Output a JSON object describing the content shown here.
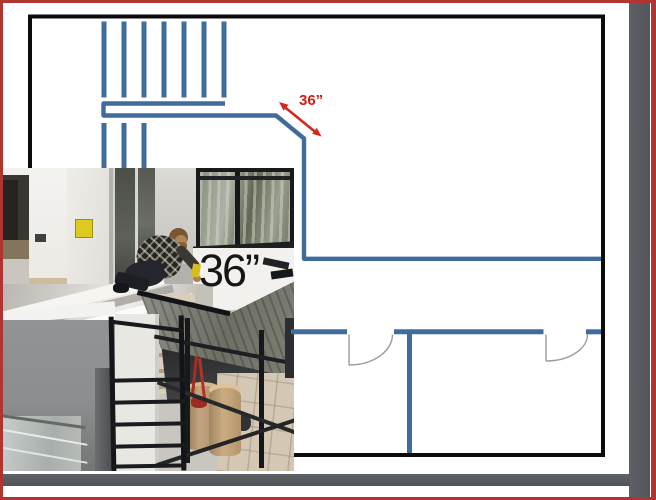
{
  "frame": {
    "border_color": "#b23430",
    "shadow_color": "#575a60",
    "background": "#ffffff"
  },
  "floor_plan": {
    "outline_color": "#0c0c0c",
    "wall_color": "#3f6c9d",
    "dimension_label": "36”",
    "dimension_color": "#cc2017",
    "stair_treads_upper": 7,
    "stair_treads_lower": 3,
    "door_count": 2
  },
  "photo": {
    "size_label": "36”",
    "description": "Construction worker kneeling on subfloor beside stair opening with scaffolding, ladder frame and buckets"
  }
}
